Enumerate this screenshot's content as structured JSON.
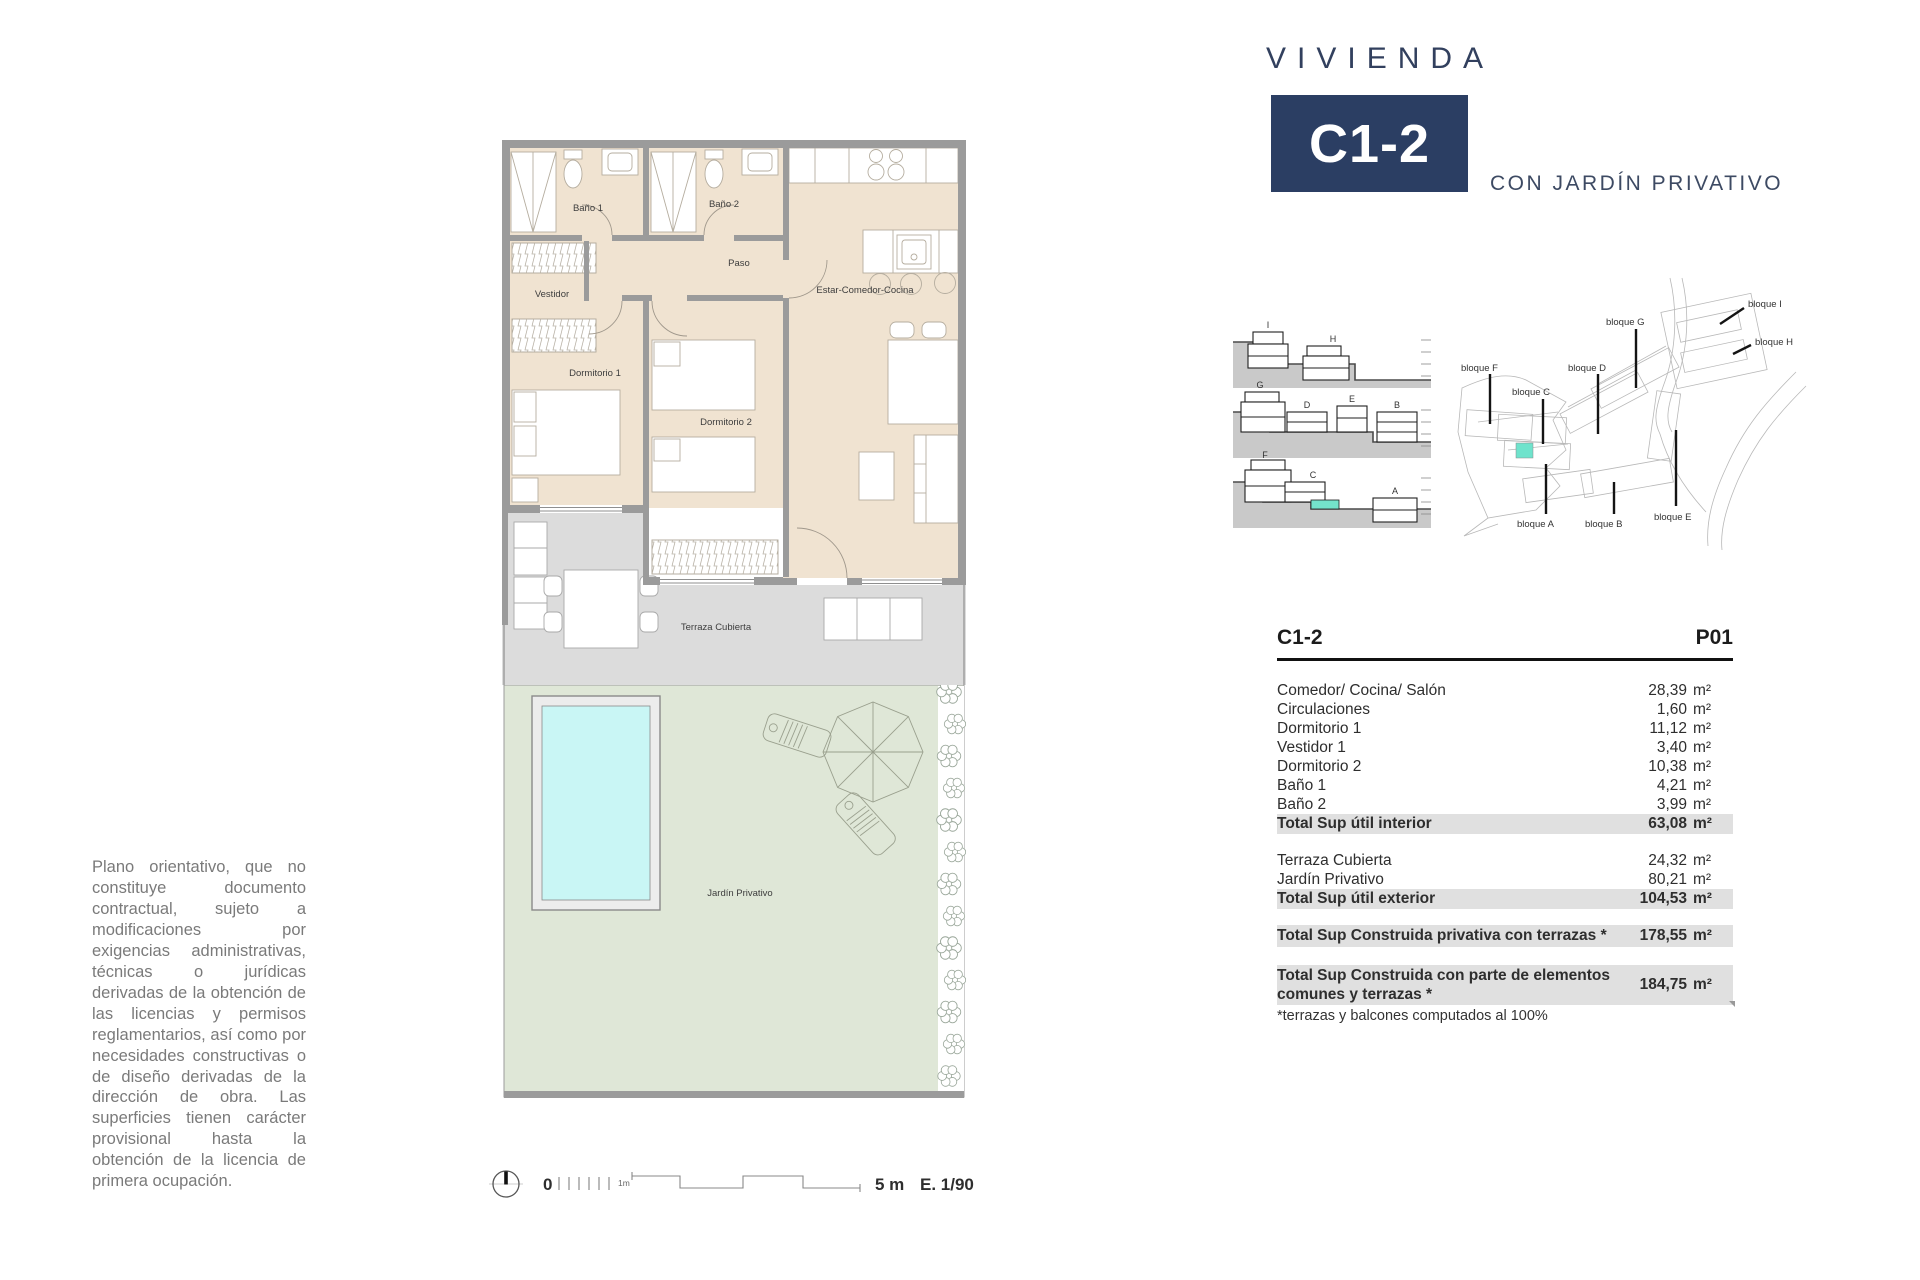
{
  "header": {
    "brand": "VIVIENDA",
    "unit": "C1-2",
    "subtitle": "CON JARDÍN PRIVATIVO"
  },
  "plan": {
    "labels": {
      "bano1": "Baño 1",
      "bano2": "Baño 2",
      "paso": "Paso",
      "vestidor": "Vestidor",
      "dorm1": "Dormitorio 1",
      "dorm2": "Dormitorio 2",
      "estar": "Estar-Comedor-Cocina",
      "terraza": "Terraza Cubierta",
      "jardin": "Jardín Privativo"
    }
  },
  "scalebar": {
    "zero": "0",
    "one_m": "1m",
    "five_m": "5 m",
    "ratio": "E. 1/90"
  },
  "sections": {
    "i": "I",
    "h": "H",
    "g": "G",
    "d": "D",
    "e": "E",
    "b": "B",
    "f": "F",
    "c": "C",
    "a": "A"
  },
  "site": {
    "f": "bloque F",
    "c": "bloque C",
    "g": "bloque G",
    "d": "bloque D",
    "a": "bloque A",
    "b": "bloque B",
    "e": "bloque E",
    "i": "bloque I",
    "h": "bloque H"
  },
  "table": {
    "unit_header": "C1-2",
    "floor_header": "P01",
    "unit": "m²",
    "interior": [
      {
        "label": "Comedor/ Cocina/ Salón",
        "value": "28,39"
      },
      {
        "label": "Circulaciones",
        "value": "1,60"
      },
      {
        "label": "Dormitorio 1",
        "value": "11,12"
      },
      {
        "label": "Vestidor 1",
        "value": "3,40"
      },
      {
        "label": "Dormitorio 2",
        "value": "10,38"
      },
      {
        "label": "Baño 1",
        "value": "4,21"
      },
      {
        "label": "Baño 2",
        "value": "3,99"
      }
    ],
    "interior_total": {
      "label": "Total Sup útil interior",
      "value": "63,08"
    },
    "exterior": [
      {
        "label": "Terraza Cubierta",
        "value": "24,32"
      },
      {
        "label": "Jardín Privativo",
        "value": "80,21"
      }
    ],
    "exterior_total": {
      "label": "Total Sup útil exterior",
      "value": "104,53"
    },
    "privativa": {
      "label": "Total Sup Construida privativa con terrazas *",
      "value": "178,55"
    },
    "comunes": {
      "label": "Total Sup Construida con parte de elementos comunes y terrazas *",
      "value": "184,75"
    },
    "footnote": "*terrazas y balcones computados al 100%"
  },
  "disclaimer": "Plano orientativo, que no constituye documento contractual, sujeto a modificaciones por exigencias administrativas, técnicas o jurídicas derivadas de la obtención de las licencias y permisos reglamentarios, así como por necesidades constructivas o de diseño derivadas de la dirección de obra. Las superficies tienen carácter provisional hasta la obtención de la licencia de primera ocupación.",
  "colors": {
    "navy": "#2b3e63",
    "beige": "#f0e3d1",
    "wall": "#9b9b9b",
    "terrace": "#dcdcdc",
    "garden": "#dfe7d7",
    "pool": "#c9f6f5",
    "highlight": "#74e3cb",
    "total_row": "#e0e0e0"
  }
}
